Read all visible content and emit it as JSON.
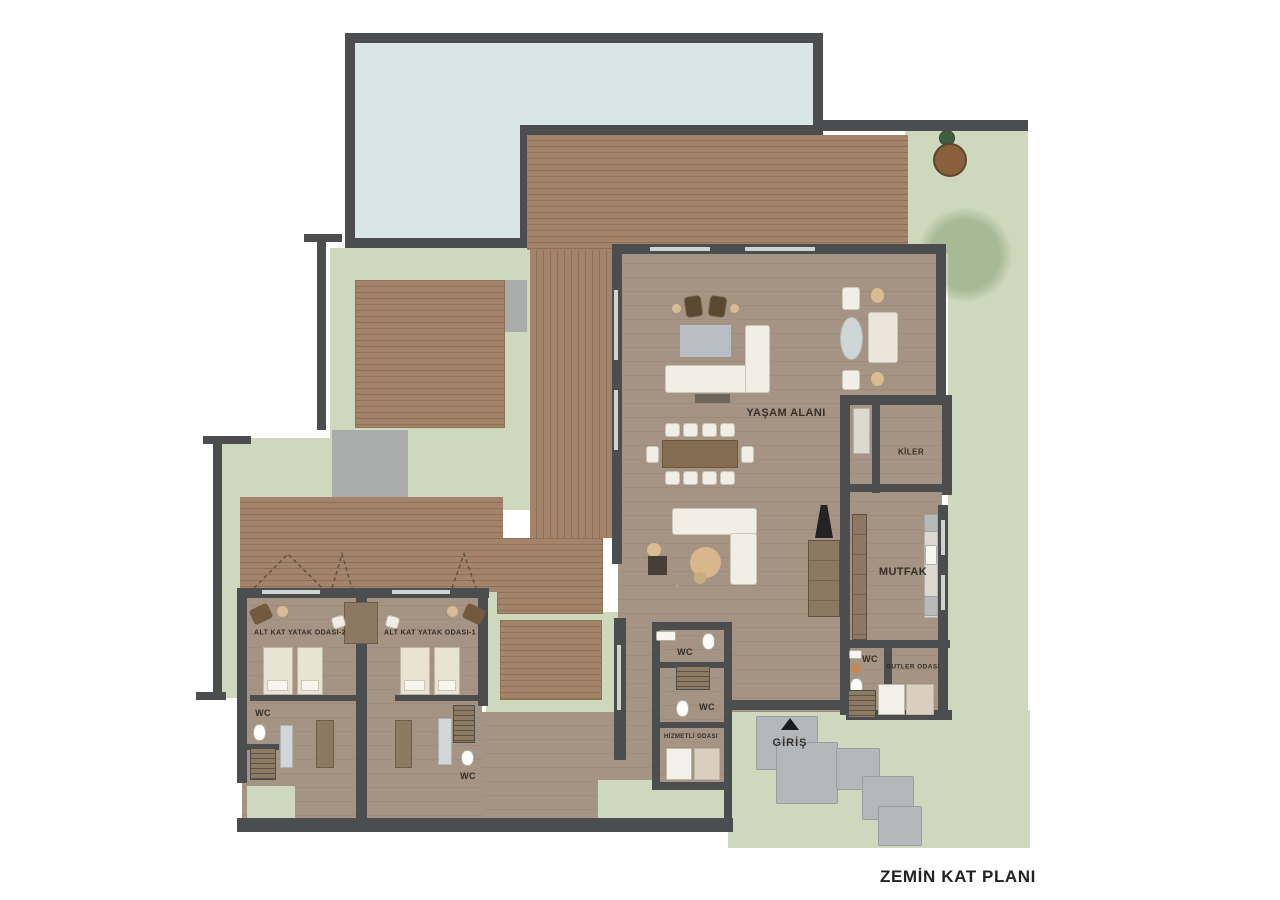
{
  "title": "ZEMİN KAT PLANI",
  "rooms": {
    "living": "YAŞAM ALANI",
    "pantry": "KİLER",
    "kitchen": "MUTFAK",
    "butler_room": "BUTLER ODASI",
    "servant_room": "HİZMETLİ ODASI",
    "bedroom_2": "ALT KAT YATAK ODASI-2",
    "bedroom_1": "ALT KAT YATAK ODASI-1",
    "entrance": "GİRİŞ",
    "wc": "WC"
  },
  "colors": {
    "wall": "#4b4d4f",
    "lawn": "#cdd8bc",
    "water": "#d9e6e6",
    "deck": "#a3846a",
    "deckline": "#8d7057",
    "floor": "#a59384",
    "floorline": "#9e8c7d",
    "pad": "#a9acab",
    "steppad": "#b5b8ba",
    "furniture": "#f0eee5",
    "beige": "#d9bc92",
    "wood": "#8d7961",
    "bed": "#e9e3d3",
    "fireplace": "#232323",
    "label": "#332f29"
  }
}
